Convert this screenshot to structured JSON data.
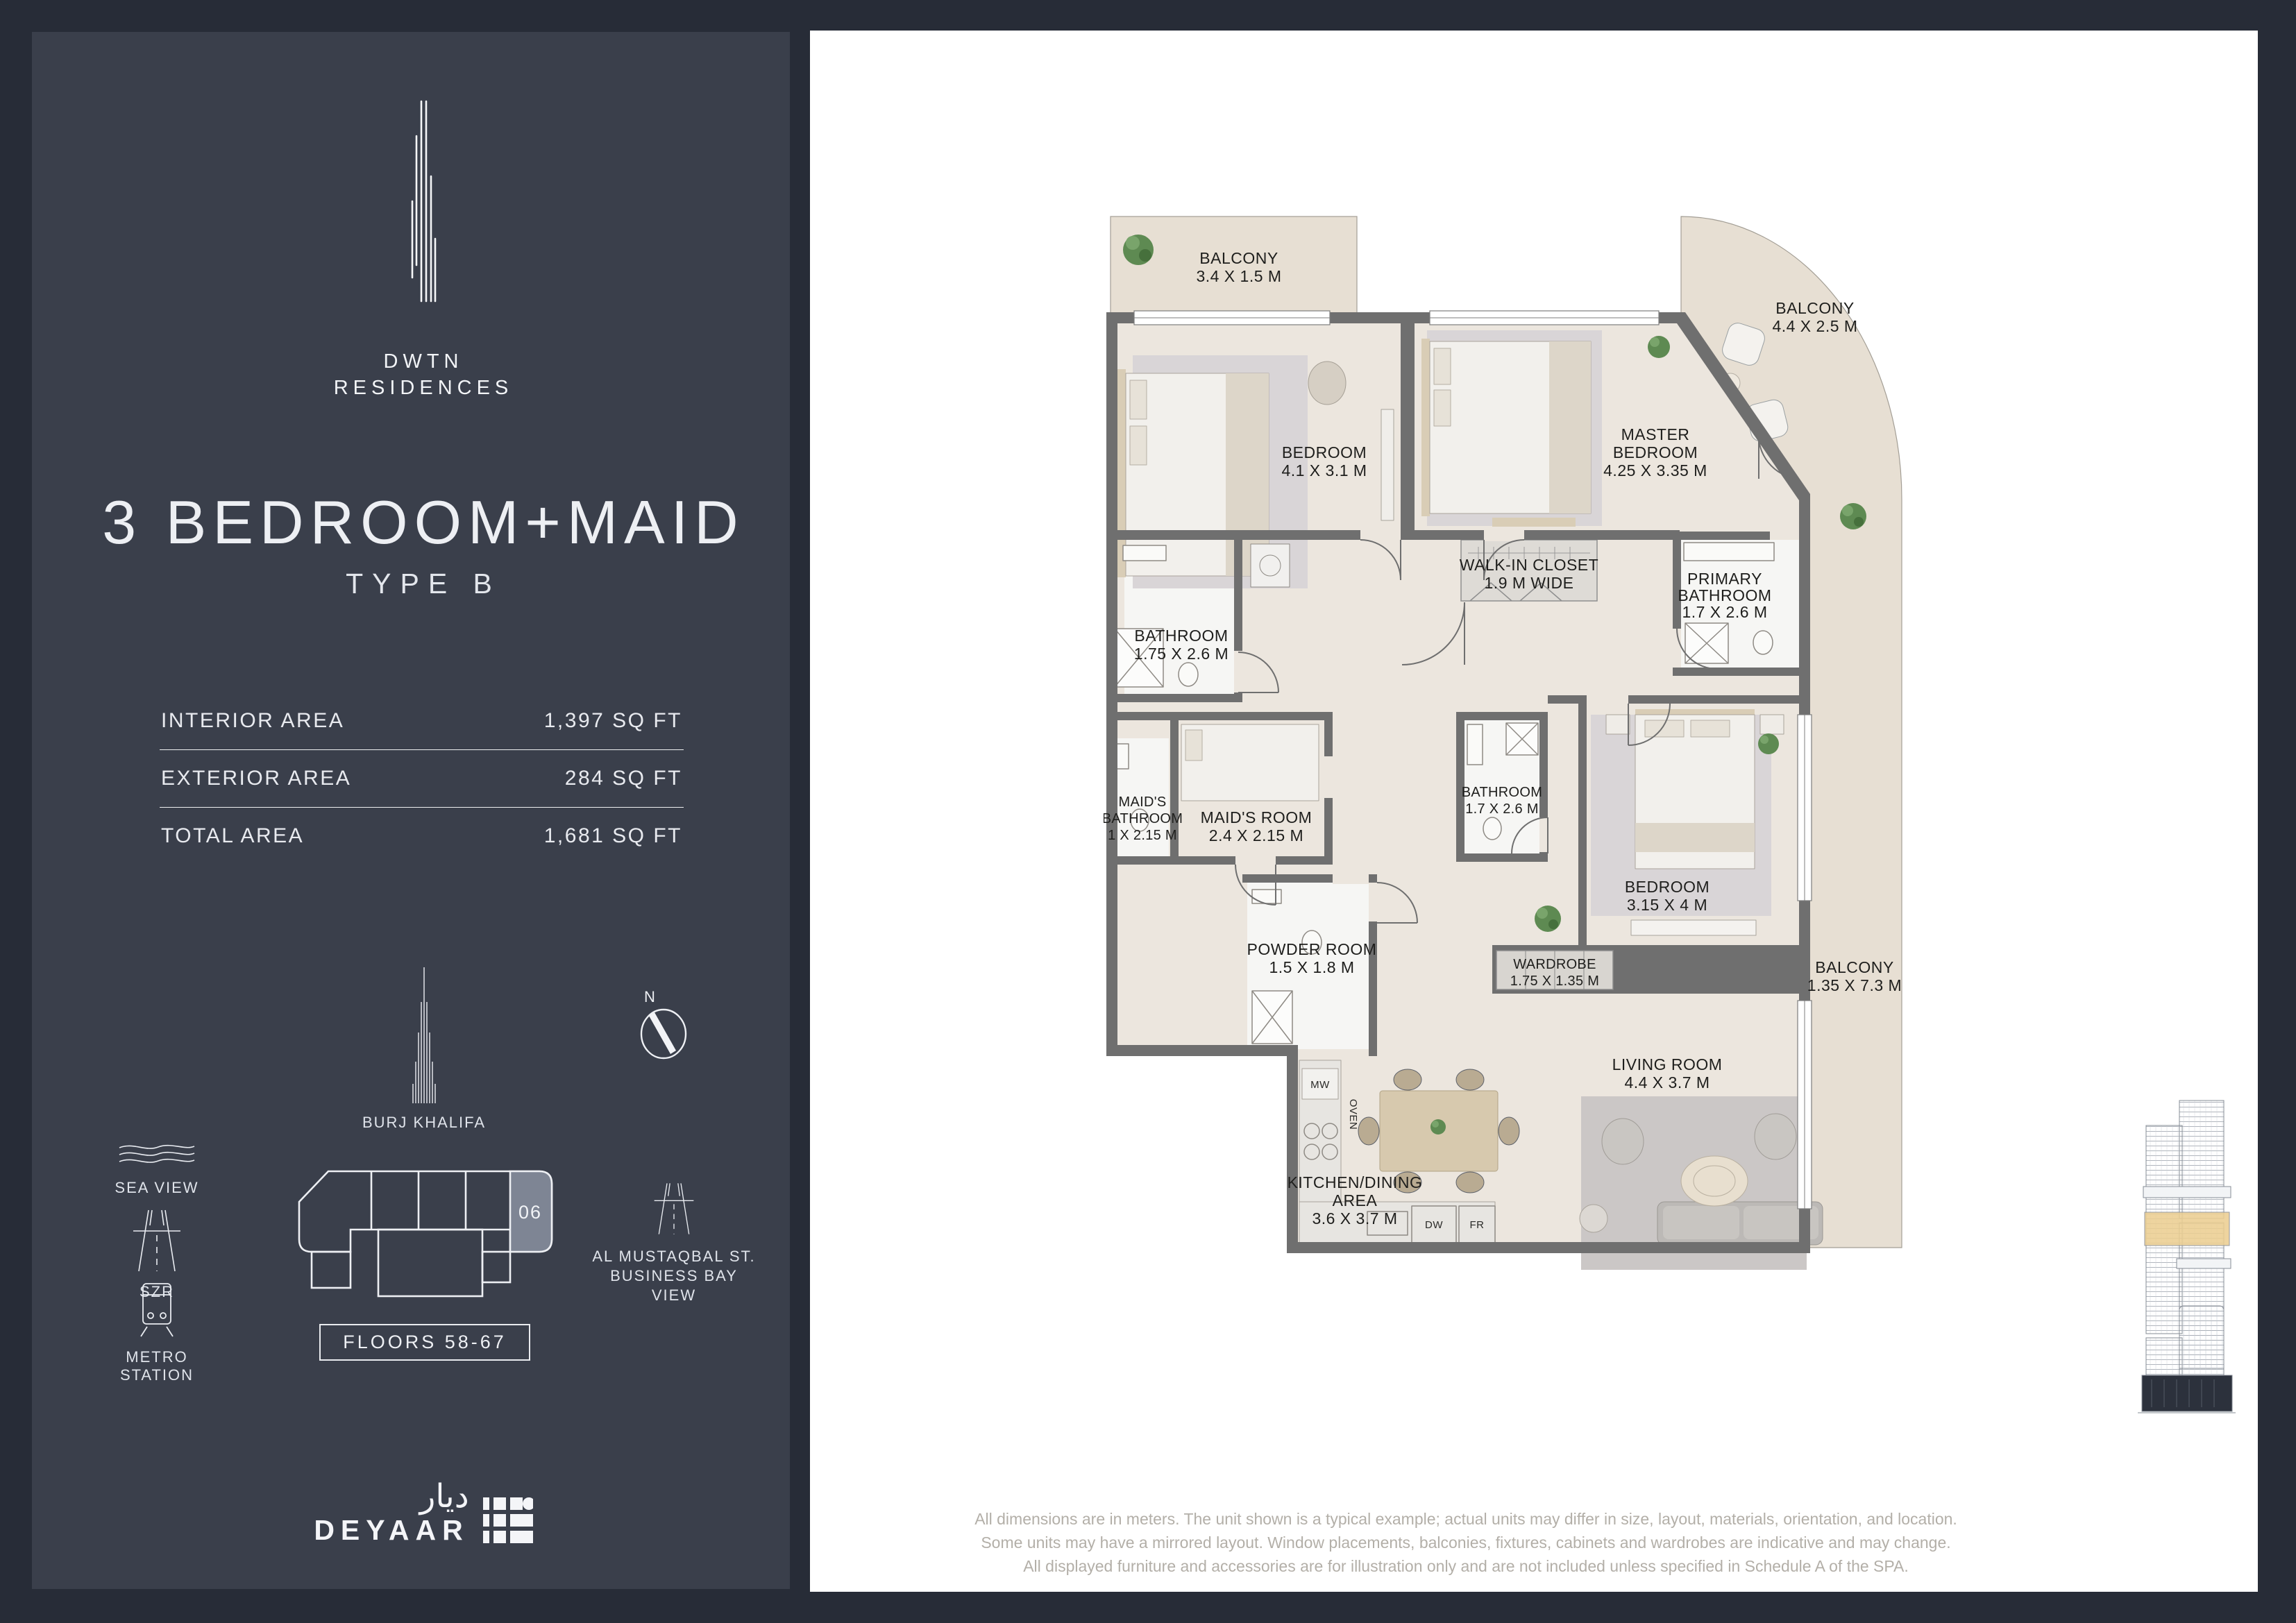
{
  "sidebar": {
    "brand": {
      "line1": "DWTN",
      "line2": "RESIDENCES"
    },
    "title": "3 BEDROOM+MAID",
    "subtitle": "TYPE B",
    "areas": [
      {
        "label": "INTERIOR AREA",
        "value": "1,397 SQ FT"
      },
      {
        "label": "EXTERIOR AREA",
        "value": "284 SQ FT"
      },
      {
        "label": "TOTAL AREA",
        "value": "1,681 SQ FT"
      }
    ],
    "landmark_label": "BURJ KHALIFA",
    "compass_n": "N",
    "legend": [
      {
        "label": "SEA VIEW"
      },
      {
        "label": "SZR"
      },
      {
        "label": "METRO STATION"
      }
    ],
    "unit_number": "06",
    "floors_label": "FLOORS 58-67",
    "street_lines": [
      "AL MUSTAQBAL ST.",
      "BUSINESS BAY",
      "VIEW"
    ],
    "developer": {
      "latin": "DEYAAR",
      "arabic": "ديار"
    }
  },
  "plan": {
    "rooms": [
      {
        "lines": [
          "BALCONY",
          "3.4 X 1.5 M"
        ]
      },
      {
        "lines": [
          "BEDROOM",
          "4.1 X 3.1 M"
        ]
      },
      {
        "lines": [
          "MASTER",
          "BEDROOM",
          "4.25 X 3.35 M"
        ]
      },
      {
        "lines": [
          "BALCONY",
          "4.4 X 2.5 M"
        ]
      },
      {
        "lines": [
          "WALK-IN CLOSET",
          "1.9 M WIDE"
        ]
      },
      {
        "lines": [
          "PRIMARY",
          "BATHROOM",
          "1.7 X 2.6 M"
        ]
      },
      {
        "lines": [
          "BATHROOM",
          "1.75 X 2.6 M"
        ]
      },
      {
        "lines": [
          "MAID'S",
          "BATHROOM",
          "1 X 2.15 M"
        ]
      },
      {
        "lines": [
          "MAID'S ROOM",
          "2.4 X 2.15 M"
        ]
      },
      {
        "lines": [
          "BATHROOM",
          "1.7 X 2.6 M"
        ]
      },
      {
        "lines": [
          "BEDROOM",
          "3.15 X 4 M"
        ]
      },
      {
        "lines": [
          "POWDER ROOM",
          "1.5 X 1.8 M"
        ]
      },
      {
        "lines": [
          "WARDROBE",
          "1.75 X 1.35 M"
        ]
      },
      {
        "lines": [
          "BALCONY",
          "1.35 X 7.3 M"
        ]
      },
      {
        "lines": [
          "LIVING ROOM",
          "4.4 X 3.7 M"
        ]
      },
      {
        "lines": [
          "KITCHEN/DINING",
          "AREA",
          "3.6 X 3.7 M"
        ]
      }
    ],
    "appliances": {
      "mw": "MW",
      "oven": "OVEN",
      "dw": "DW",
      "fr": "FR"
    },
    "disclaimer": [
      "All dimensions are in meters. The unit shown is a typical example; actual units may differ in size, layout, materials, orientation, and location.",
      "Some units may have a mirrored layout. Window placements, balconies, fixtures, cabinets and wardrobes are indicative and may change.",
      "All displayed furniture and accessories are for illustration only and are not included unless specified in Schedule A of the SPA."
    ]
  },
  "colors": {
    "background": "#272c37",
    "panel": "#3a3f4b",
    "paper": "#ffffff",
    "floor": "#ece6de",
    "balcony_floor": "#e7dfd3",
    "wall": "#6f6f6f",
    "bath_floor": "#f6f6f4",
    "gold_band": "#eccf92",
    "unit_fill": "#7e8594",
    "ink": "#1e1e1c"
  }
}
